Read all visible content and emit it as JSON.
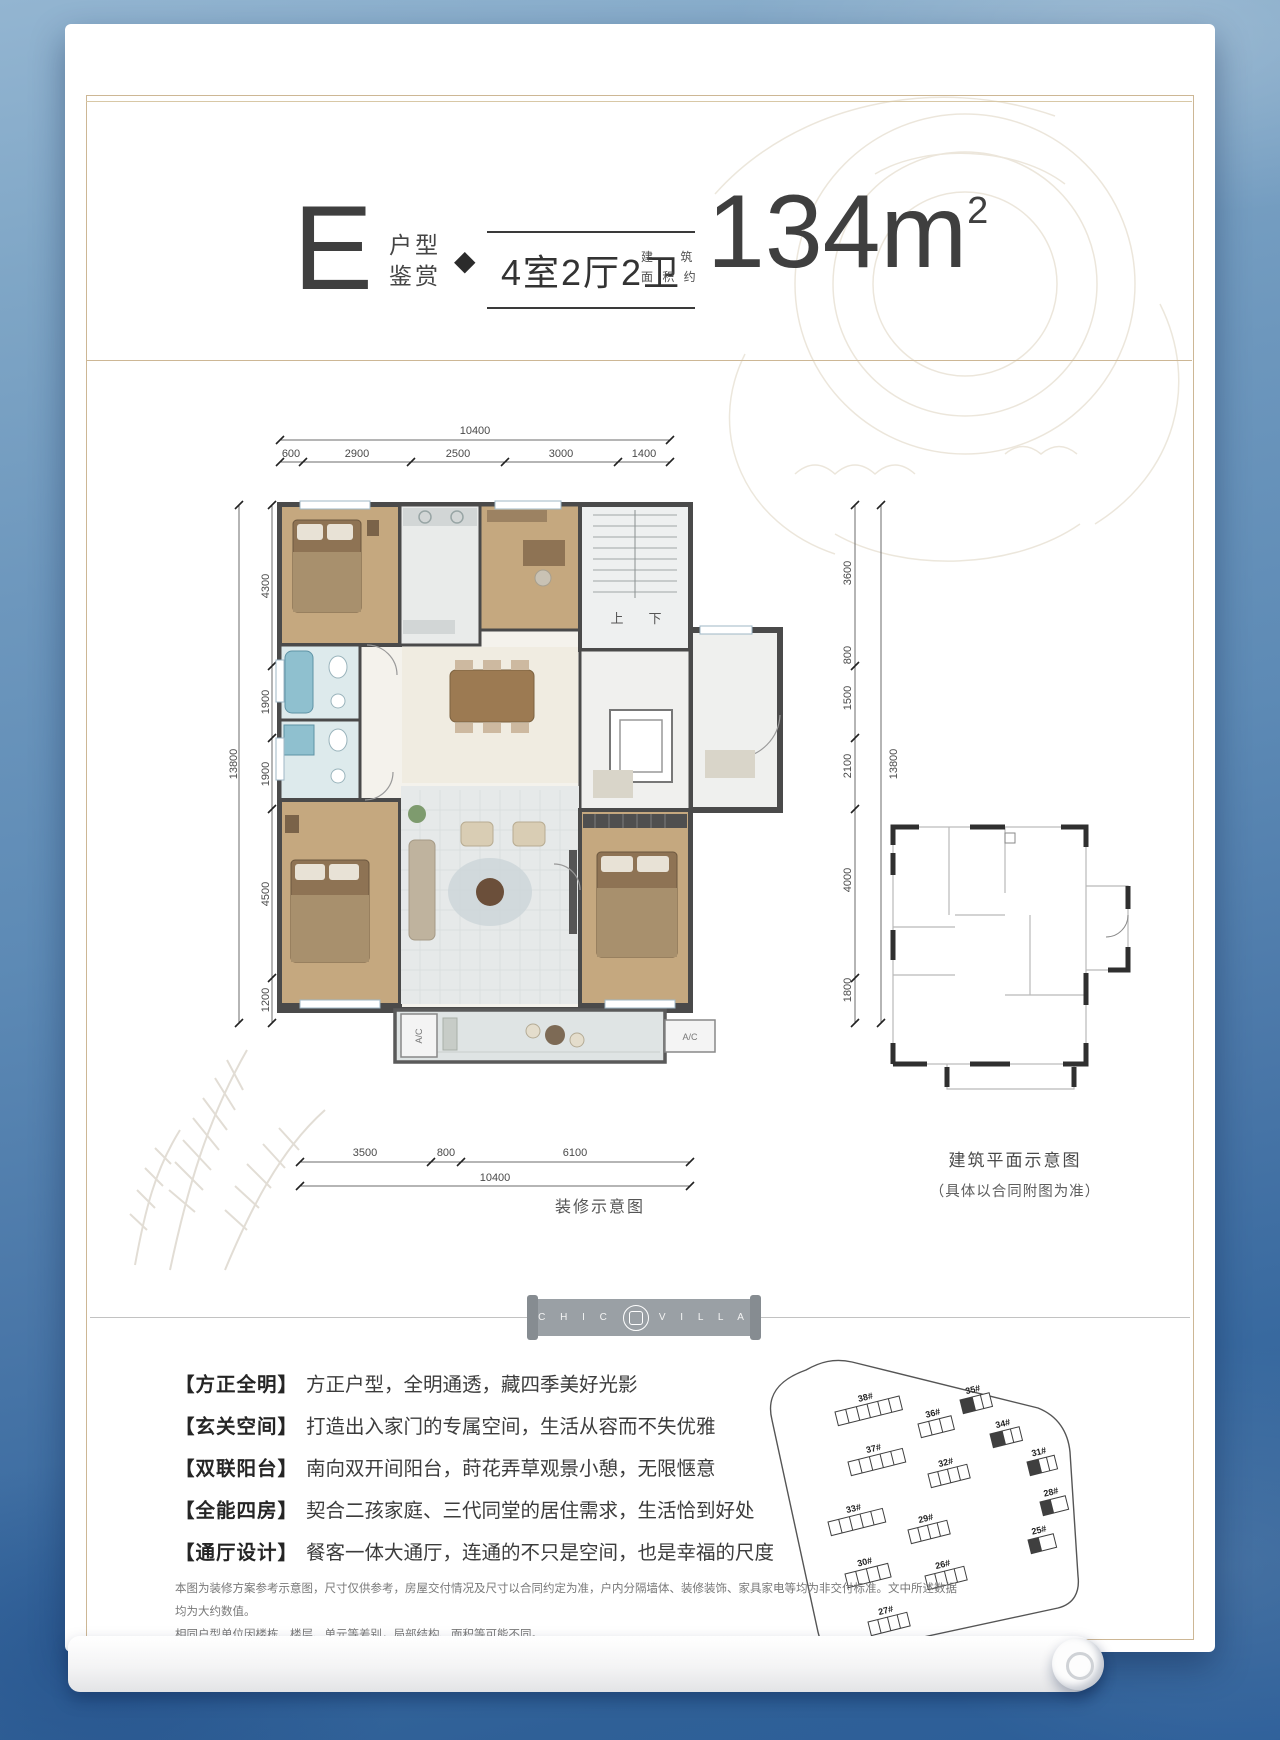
{
  "header": {
    "plan_letter": "E",
    "plan_label_line1": "户型",
    "plan_label_line2": "鉴赏",
    "diamond": "◆",
    "layout": "4室2厅2卫",
    "area_label_line1": "建 筑",
    "area_label_line2": "面 积 约",
    "area_value": "134m",
    "area_unit_sup": "2"
  },
  "floorplan": {
    "dims_top": {
      "total": "10400",
      "segments": [
        "600",
        "2900",
        "2500",
        "3000",
        "1400"
      ]
    },
    "dims_left": {
      "total": "13800",
      "segments": [
        "4300",
        "1900",
        "1900",
        "4500",
        "1200"
      ]
    },
    "dims_right": {
      "total": "13800",
      "segments": [
        "3600",
        "800",
        "1500",
        "2100",
        "4000",
        "1800"
      ]
    },
    "dims_bottom": {
      "total": "10400",
      "segments": [
        "3500",
        "800",
        "6100"
      ]
    },
    "stair_up": "上",
    "stair_down": "下",
    "ac_label": "A/C",
    "caption": "装修示意图"
  },
  "mini_plan": {
    "caption_line1": "建筑平面示意图",
    "caption_line2": "（具体以合同附图为准）"
  },
  "logo": {
    "chic": "C H I C",
    "villa": "V I L L A"
  },
  "features": [
    {
      "tag": "【方正全明】",
      "text": "方正户型，全明通透，藏四季美好光影"
    },
    {
      "tag": "【玄关空间】",
      "text": "打造出入家门的专属空间，生活从容而不失优雅"
    },
    {
      "tag": "【双联阳台】",
      "text": "南向双开间阳台，莳花弄草观景小憩，无限惬意"
    },
    {
      "tag": "【全能四房】",
      "text": "契合二孩家庭、三代同堂的居住需求，生活恰到好处"
    },
    {
      "tag": "【通厅设计】",
      "text": "餐客一体大通厅，连通的不只是空间，也是幸福的尺度"
    }
  ],
  "disclaimer": {
    "line1": "本图为装修方案参考示意图，尺寸仅供参考，房屋交付情况及尺寸以合同约定为准，户内分隔墙体、装修装饰、家具家电等均为非交付标准。文中所述数据均为大约数值。",
    "line2": "相同户型单位因楼栋、楼层、单元等差别，局部结构、面积等可能不同。"
  },
  "site_plan": {
    "buildings": [
      "38#",
      "36#",
      "35#",
      "37#",
      "34#",
      "31#",
      "32#",
      "28#",
      "33#",
      "29#",
      "25#",
      "30#",
      "26#",
      "27#"
    ]
  },
  "colors": {
    "frame_gold": "#cdb795",
    "background_blue_top": "#93b5d1",
    "background_blue_bottom": "#2c5e99",
    "wall_dark": "#4a4a4a",
    "wood_floor": "#c5a87f",
    "tile_gray": "#e6e9e9",
    "bath_teal": "#8fc0cf",
    "logo_bar_gray": "#9aa0a5",
    "text_dark": "#3f3f3f"
  }
}
